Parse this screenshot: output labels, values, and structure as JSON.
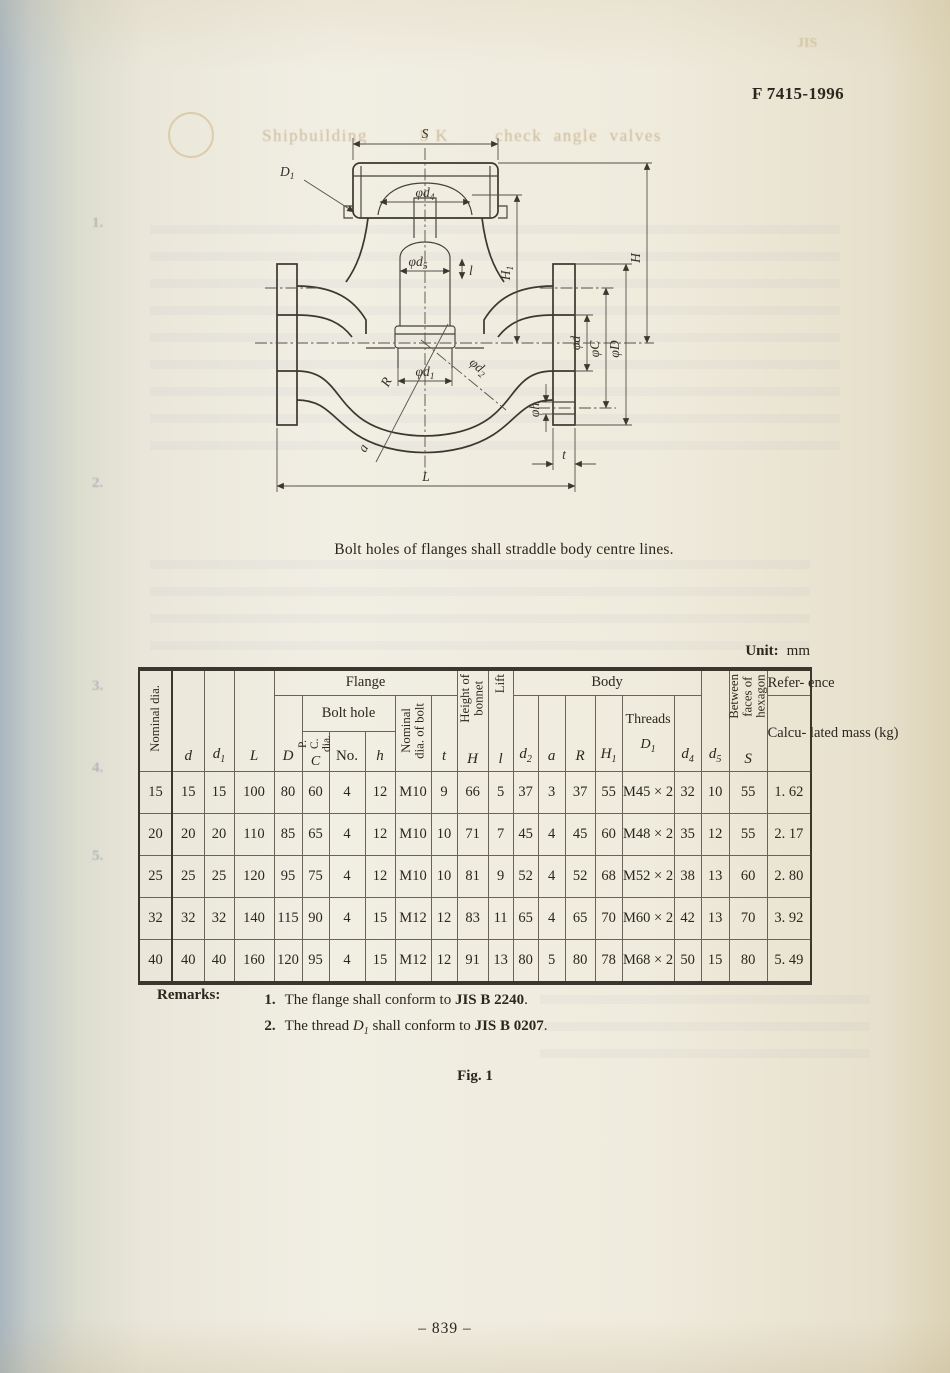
{
  "page": {
    "doc_code": "F 7415-1996",
    "ghost_title": "Shipbuilding         5 K        check  angle  valves",
    "ghost_jis": "JIS",
    "ghost_margin_numbers": [
      "1.",
      "2.",
      "3.",
      "4.",
      "5."
    ],
    "caption": "Bolt holes of flanges shall straddle body centre lines.",
    "unit_bold": "Unit:",
    "unit_value": "mm",
    "fig_label": "Fig. 1",
    "page_number": "–  839  –",
    "remarks": {
      "label": "Remarks:",
      "item1": {
        "num": "1.",
        "text": "The flange shall conform to ",
        "std": "JIS B 2240",
        "end": "."
      },
      "item2": {
        "num": "2.",
        "pre": "The thread ",
        "var": "D",
        "sub": "1",
        "mid": " shall conform to ",
        "std": "JIS B 0207",
        "end": "."
      }
    }
  },
  "drawing": {
    "labels": {
      "S": "S",
      "L": "L",
      "t": "t",
      "a": "a",
      "R": "R",
      "lift": "l",
      "H": "H",
      "H1": {
        "b": "H",
        "s": "1"
      },
      "D1": {
        "b": "D",
        "s": "1"
      },
      "d4": {
        "b": "φd",
        "s": "4"
      },
      "d5": {
        "b": "φd",
        "s": "5"
      },
      "d1": {
        "b": "φd",
        "s": "1"
      },
      "d2": {
        "b": "φd",
        "s": "2"
      },
      "d": "φd",
      "C": "φC",
      "Dcap": "φD",
      "h": "φh"
    }
  },
  "table": {
    "groups": {
      "flange": "Flange",
      "bolt_hole": "Bolt hole",
      "body": "Body",
      "threads": "Threads",
      "reference": "Refer-\nence"
    },
    "headers": {
      "nominal_dia": "Nominal dia.",
      "d": {
        "b": "d"
      },
      "d1": {
        "b": "d",
        "s": "1"
      },
      "L": {
        "b": "L"
      },
      "D": {
        "b": "D"
      },
      "pc_dia": "P. C.\ndia.",
      "pc_C": "C",
      "no": "No.",
      "h": {
        "b": "h"
      },
      "bolt": "Nominal\ndia. of bolt",
      "t": {
        "b": "t"
      },
      "height_bonnet": "Height of\nbonnet",
      "H": {
        "b": "H"
      },
      "lift": "Lift",
      "l": {
        "b": "l"
      },
      "d2": {
        "b": "d",
        "s": "2"
      },
      "a": {
        "b": "a"
      },
      "R": {
        "b": "R"
      },
      "H1": {
        "b": "H",
        "s": "1"
      },
      "D1": {
        "b": "D",
        "s": "1"
      },
      "d4": {
        "b": "d",
        "s": "4"
      },
      "d5": {
        "b": "d",
        "s": "5"
      },
      "hex": "Between\nfaces of\nhexagon",
      "S": {
        "b": "S"
      },
      "calc_mass": "Calcu-\nlated\nmass\n(kg)"
    },
    "rows": [
      [
        "15",
        "15",
        "15",
        "100",
        "80",
        "60",
        "4",
        "12",
        "M10",
        "9",
        "66",
        "5",
        "37",
        "3",
        "37",
        "55",
        "M45 × 2",
        "32",
        "10",
        "55",
        "1. 62"
      ],
      [
        "20",
        "20",
        "20",
        "110",
        "85",
        "65",
        "4",
        "12",
        "M10",
        "10",
        "71",
        "7",
        "45",
        "4",
        "45",
        "60",
        "M48 × 2",
        "35",
        "12",
        "55",
        "2. 17"
      ],
      [
        "25",
        "25",
        "25",
        "120",
        "95",
        "75",
        "4",
        "12",
        "M10",
        "10",
        "81",
        "9",
        "52",
        "4",
        "52",
        "68",
        "M52 × 2",
        "38",
        "13",
        "60",
        "2. 80"
      ],
      [
        "32",
        "32",
        "32",
        "140",
        "115",
        "90",
        "4",
        "15",
        "M12",
        "12",
        "83",
        "11",
        "65",
        "4",
        "65",
        "70",
        "M60 × 2",
        "42",
        "13",
        "70",
        "3. 92"
      ],
      [
        "40",
        "40",
        "40",
        "160",
        "120",
        "95",
        "4",
        "15",
        "M12",
        "12",
        "91",
        "13",
        "80",
        "5",
        "80",
        "78",
        "M68 × 2",
        "50",
        "15",
        "80",
        "5. 49"
      ]
    ]
  }
}
